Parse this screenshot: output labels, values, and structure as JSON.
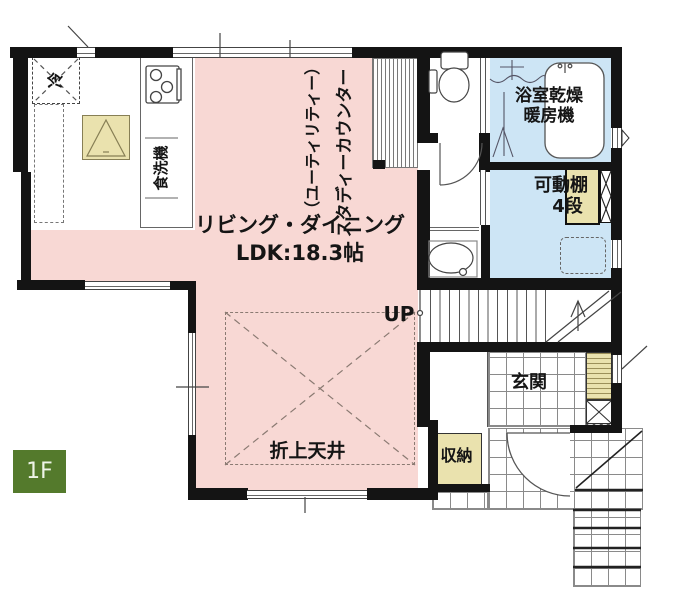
{
  "floor_badge": "1F",
  "colors": {
    "room-pink": "#f8d8d4",
    "room-blue": "#cde5f5",
    "fixture-beige": "#eae2ae",
    "badge-green": "#547a2c",
    "wall": "#141414",
    "line": "#555555",
    "text": "#151515"
  },
  "kitchen": {
    "fridge_label": "冷",
    "dishwasher_label": "食洗機"
  },
  "study_counter": {
    "label_main": "スタディーカウンター",
    "label_sub": "（ユーティリティー）"
  },
  "bathroom": {
    "label_line1": "浴室乾燥",
    "label_line2": "暖房機"
  },
  "laundry": {
    "shelf_line1": "可動棚",
    "shelf_line2": "4段"
  },
  "living": {
    "name": "リビング・ダイニング",
    "size": "LDK:18.3帖",
    "ceiling_label": "折上天井"
  },
  "stairs": {
    "up_label": "UP"
  },
  "entrance": {
    "label": "玄関",
    "storage_label": "収納"
  }
}
